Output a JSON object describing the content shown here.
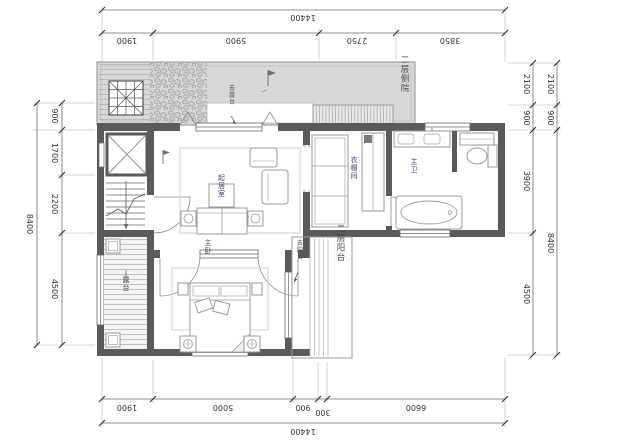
{
  "drawing": {
    "type": "architectural-floor-plan",
    "dims": {
      "top": {
        "total": "14400",
        "segments": [
          "1900",
          "5900",
          "2750",
          "3850"
        ]
      },
      "bottom": {
        "total": "14400",
        "segments": [
          "1900",
          "5000",
          "900",
          "300",
          "6600"
        ]
      },
      "left": {
        "total": "8400",
        "segments": [
          "900",
          "1700",
          "2200",
          "4500"
        ]
      },
      "right": {
        "segments": [
          "2100",
          "900",
          "3900",
          "4500"
        ],
        "outer": [
          "2100",
          "900",
          "8400"
        ]
      }
    },
    "labels": {
      "side_yard": "二层侧院",
      "balcony": "二层阳台",
      "to_balcony": "去阳台",
      "to_terrace": "去露台",
      "deck": "露台",
      "closet": "衣帽间",
      "master_bath": "主卫",
      "master_bedroom": "主卧",
      "living_room": "起居室"
    },
    "colors": {
      "wall": "#5a5a5a",
      "terrace_fill": "#d8d8d6",
      "room_label": "#3c4668",
      "dim_text": "#333333",
      "background": "#ffffff"
    }
  }
}
